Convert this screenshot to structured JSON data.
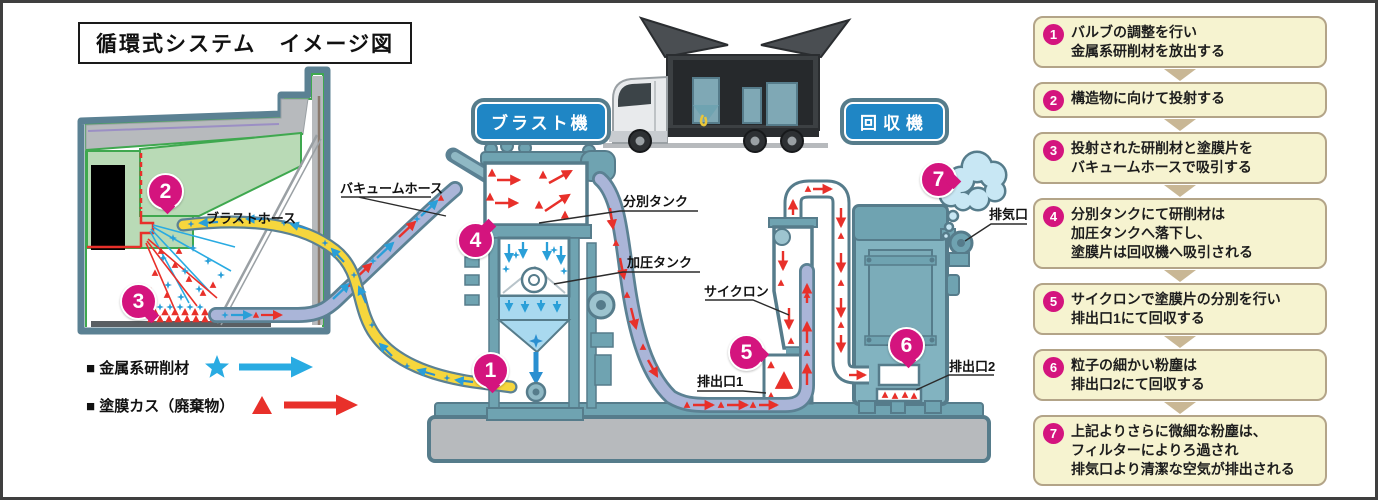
{
  "title": "循環式システム　イメージ図",
  "machines": {
    "blast": "ブラスト機",
    "recovery": "回収機"
  },
  "parts": {
    "vacuum_hose": "バキュームホース",
    "blast_hose": "ブラストホース",
    "separation_tank": "分別タンク",
    "pressure_tank": "加圧タンク",
    "cyclone": "サイクロン",
    "outlet_1": "排出口1",
    "outlet_2": "排出口2",
    "exhaust_port": "排気口"
  },
  "legend": {
    "abrasive": {
      "label": "■ 金属系研削材",
      "color": "#29abe2",
      "marker": "star-and-arrow"
    },
    "waste": {
      "label": "■ 塗膜カス（廃棄物）",
      "color": "#e8302a",
      "marker": "triangle-and-arrow"
    }
  },
  "markers": [
    "1",
    "2",
    "3",
    "4",
    "5",
    "6",
    "7"
  ],
  "steps": [
    {
      "num": "1",
      "text": "バルブの調整を行い\n金属系研削材を放出する"
    },
    {
      "num": "2",
      "text": "構造物に向けて投射する"
    },
    {
      "num": "3",
      "text": "投射された研削材と塗膜片を\nバキュームホースで吸引する"
    },
    {
      "num": "4",
      "text": "分別タンクにて研削材は\n加圧タンクへ落下し、\n塗膜片は回収機へ吸引される"
    },
    {
      "num": "5",
      "text": "サイクロンで塗膜片の分別を行い\n排出口1にて回収する"
    },
    {
      "num": "6",
      "text": "粒子の細かい粉塵は\n排出口2にて回収する"
    },
    {
      "num": "7",
      "text": "上記よりさらに微細な粉塵は、\nフィルターによりろ過され\n排気口より清潔な空気が排出される"
    }
  ],
  "colors": {
    "accent_magenta": "#d4147e",
    "machine_teal": "#567c8b",
    "abrasive_blue": "#29abe2",
    "waste_red": "#e8302a",
    "plate_blue": "#1f86c5",
    "step_bg": "#f6f3d0",
    "hose_yellow": "#f6d63d",
    "hose_lavender": "#aab5d8"
  }
}
